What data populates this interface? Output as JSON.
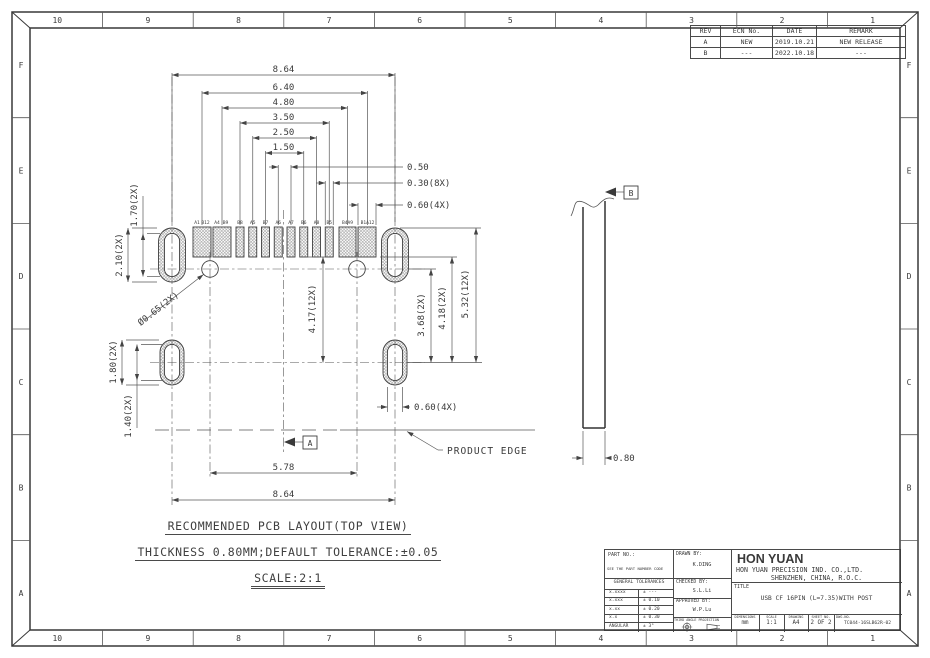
{
  "zones": {
    "columns": [
      "10",
      "9",
      "8",
      "7",
      "6",
      "5",
      "4",
      "3",
      "2",
      "1"
    ],
    "rows": [
      "F",
      "E",
      "D",
      "C",
      "B",
      "A"
    ]
  },
  "revision_table": {
    "headers": [
      "REV",
      "ECN No.",
      "DATE",
      "REMARK"
    ],
    "rows": [
      [
        "A",
        "NEW",
        "2019.10.21",
        "NEW RELEASE"
      ],
      [
        "B",
        "---",
        "2022.10.18",
        "---"
      ]
    ]
  },
  "notes": {
    "line1": "RECOMMENDED PCB LAYOUT(TOP VIEW)",
    "line2": "THICKNESS 0.80MM;DEFAULT TOLERANCE:±0.05",
    "line3": "SCALE:2:1"
  },
  "labels": {
    "product_edge": "PRODUCT EDGE",
    "datum_a": "A",
    "datum_b": "B"
  },
  "pins": [
    "A1",
    "B12",
    "A4",
    "B9",
    "B8",
    "A5",
    "B7",
    "A6",
    "A7",
    "B6",
    "A8",
    "B5",
    "B4A9",
    "B1A12"
  ],
  "dimensions": {
    "top": [
      "8.64",
      "6.40",
      "4.80",
      "3.50",
      "2.50",
      "1.50"
    ],
    "leaders": [
      "0.50",
      "0.30(8X)",
      "0.60(4X)"
    ],
    "left_upper": [
      "1.70(2X)",
      "2.10(2X)"
    ],
    "left_lower": [
      "1.80(2X)",
      "1.40(2X)"
    ],
    "hole": "Ø0.65(2X)",
    "vertical": [
      "4.17(12X)",
      "3.68(2X)",
      "4.18(2X)",
      "5.32(12X)"
    ],
    "bottom": [
      "5.78",
      "8.64"
    ],
    "slot": "0.60(4X)",
    "thickness": "0.80"
  },
  "title_block": {
    "part_no_label": "PART NO.:",
    "part_no_value": "SEE THE PART NUMBER CODE",
    "drawn_by_label": "DRAWN BY:",
    "drawn_by": "K.DING",
    "checked_by_label": "CHECKED BY:",
    "checked_by": "S.L.Li",
    "approved_by_label": "APPROVED BY:",
    "approved_by": "W.P.Lu",
    "general_tolerances_label": "GENERAL TOLERANCES",
    "tolerances": [
      [
        "x.xxxx",
        "± ---"
      ],
      [
        "x.xxx",
        "± 0.10"
      ],
      [
        "x.xx",
        "± 0.20"
      ],
      [
        "x.x",
        "± 0.30"
      ],
      [
        "ANGULAR",
        "± 3°"
      ]
    ],
    "projection_label": "THIRD ANGLE PROJECTION",
    "company_name": "HON YUAN",
    "company_full": "HON YUAN PRECISION IND. CO.,LTD.",
    "company_location": "SHENZHEN, CHINA, R.O.C.",
    "title_label": "TITLE",
    "title": "USB CF 16PIN (L=7.35)WITH POST",
    "dimensions_label": "DIMENSIONS",
    "dimensions_value": "mm",
    "scale_label": "SCALE",
    "scale_value": "1:1",
    "drawing_label": "DRAWING",
    "drawing_value": "A4",
    "sheet_label": "SHEET NO.",
    "sheet_value": "2 OF 2",
    "dwg_label": "DWG.NO.",
    "dwg_value": "TC044-16SLB62R-02"
  }
}
